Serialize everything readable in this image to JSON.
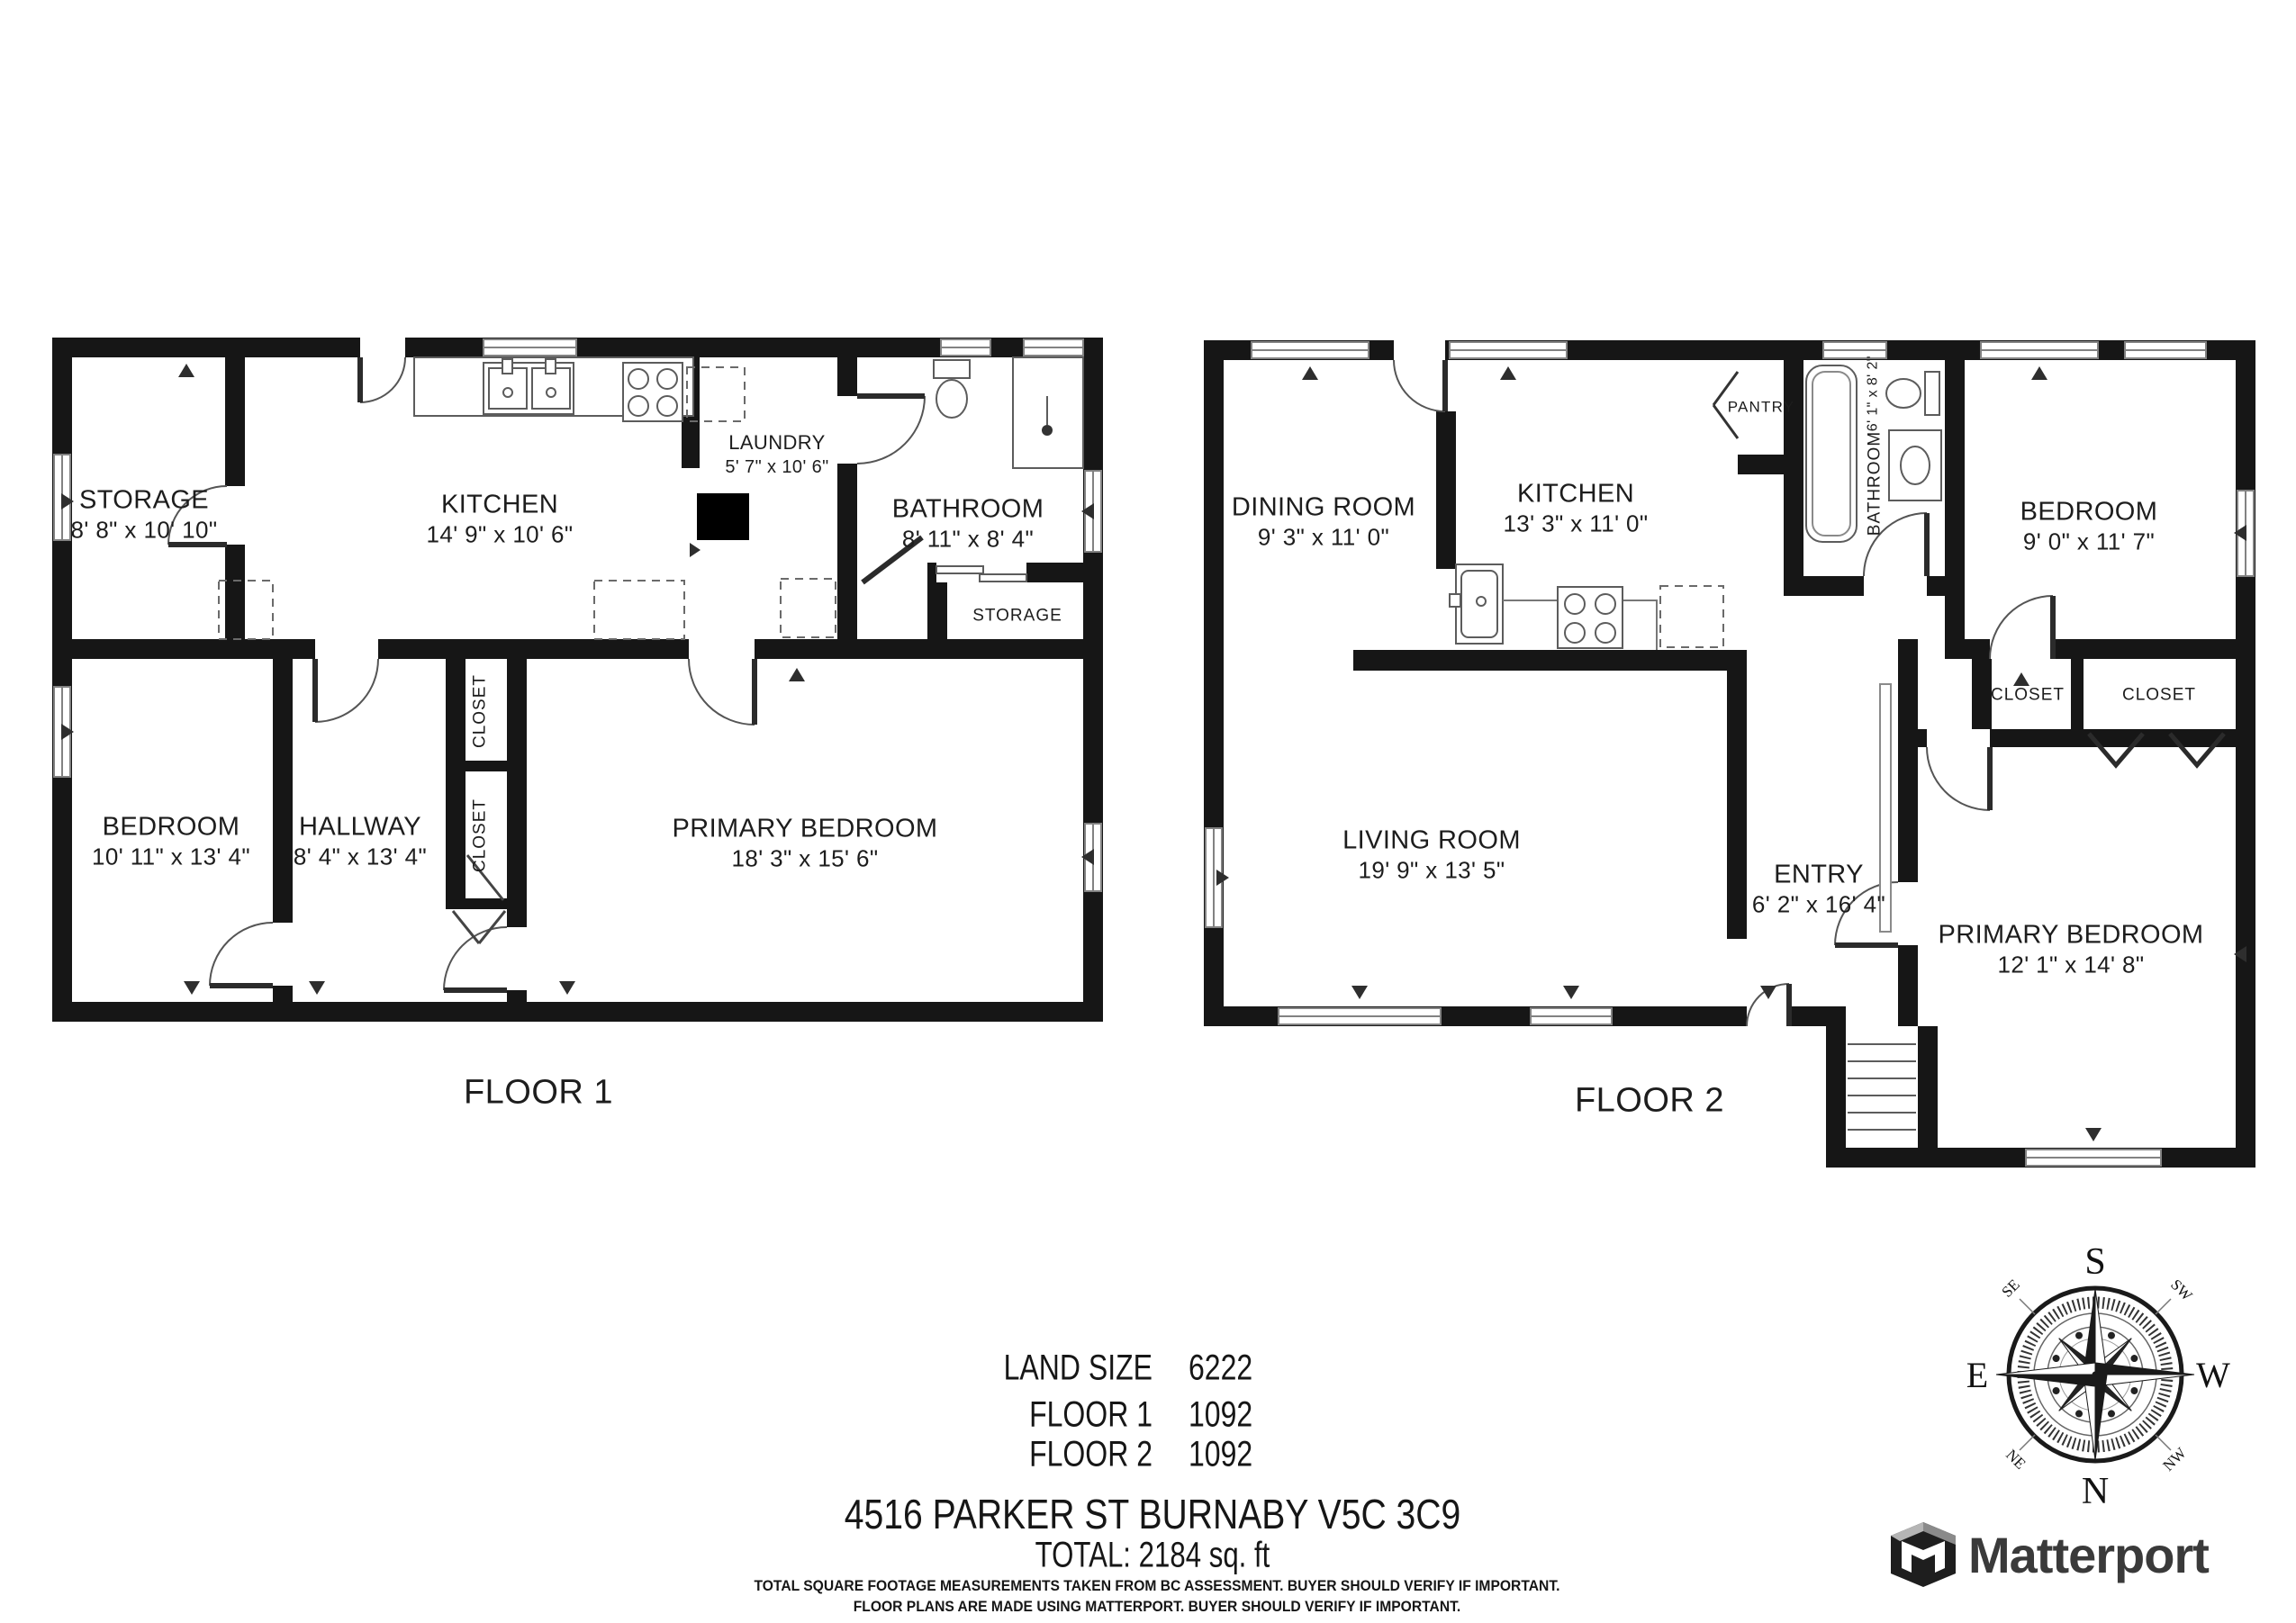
{
  "floors": [
    {
      "label": "FLOOR 1",
      "rooms": [
        {
          "name": "STORAGE",
          "dims": "8' 8\" x 10' 10\""
        },
        {
          "name": "KITCHEN",
          "dims": "14' 9\" x 10' 6\""
        },
        {
          "name": "LAUNDRY",
          "dims": "5' 7\" x 10' 6\""
        },
        {
          "name": "BATHROOM",
          "dims": "8' 11\" x 8' 4\""
        },
        {
          "name": "STORAGE",
          "dims": ""
        },
        {
          "name": "BEDROOM",
          "dims": "10' 11\" x 13' 4\""
        },
        {
          "name": "HALLWAY",
          "dims": "8' 4\" x 13' 4\""
        },
        {
          "name": "CLOSET",
          "dims": ""
        },
        {
          "name": "CLOSET",
          "dims": ""
        },
        {
          "name": "PRIMARY BEDROOM",
          "dims": "18' 3\" x 15' 6\""
        }
      ]
    },
    {
      "label": "FLOOR 2",
      "rooms": [
        {
          "name": "DINING ROOM",
          "dims": "9' 3\" x 11' 0\""
        },
        {
          "name": "KITCHEN",
          "dims": "13' 3\" x 11' 0\""
        },
        {
          "name": "PANTRY",
          "dims": ""
        },
        {
          "name": "BATHROOM",
          "dims": "6' 1\" x 8' 2\""
        },
        {
          "name": "BEDROOM",
          "dims": "9' 0\" x 11' 7\""
        },
        {
          "name": "LIVING ROOM",
          "dims": "19' 9\" x 13' 5\""
        },
        {
          "name": "ENTRY",
          "dims": "6' 2\" x 16' 4\""
        },
        {
          "name": "CLOSET",
          "dims": ""
        },
        {
          "name": "CLOSET",
          "dims": ""
        },
        {
          "name": "PRIMARY BEDROOM",
          "dims": "12' 1\" x 14' 8\""
        }
      ]
    }
  ],
  "summary": {
    "land_size_label": "LAND SIZE",
    "land_size_value": "6222",
    "floor1_label": "FLOOR 1",
    "floor1_value": "1092",
    "floor2_label": "FLOOR 2",
    "floor2_value": "1092",
    "address": "4516 PARKER ST BURNABY V5C 3C9",
    "total": "TOTAL: 2184 sq. ft",
    "disclaimer_line1": "TOTAL SQUARE FOOTAGE MEASUREMENTS TAKEN FROM BC ASSESSMENT. BUYER SHOULD VERIFY IF IMPORTANT.",
    "disclaimer_line2": "FLOOR PLANS ARE MADE USING MATTERPORT. BUYER SHOULD VERIFY IF IMPORTANT."
  },
  "compass": {
    "n": "N",
    "s": "S",
    "e": "E",
    "w": "W",
    "ne": "NE",
    "nw": "NW",
    "se": "SE",
    "sw": "SW"
  },
  "branding": {
    "logo_text": "Matterport"
  }
}
